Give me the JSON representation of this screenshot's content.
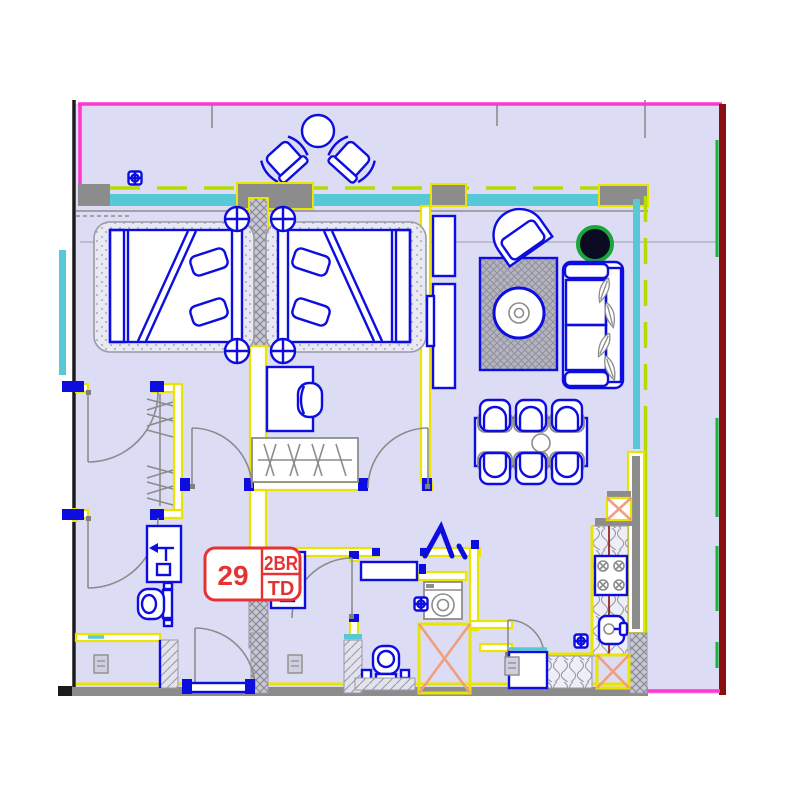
{
  "unit_label": {
    "number": "29",
    "type": "2BR",
    "suffix": "TD"
  },
  "palette": {
    "floor": "#dcdcf4",
    "blue": "#0d0de0",
    "yellow": "#e9e500",
    "gray": "#8c8c8c",
    "cyan": "#56c8d8",
    "chartreuse": "#b4dc00",
    "magenta": "#ff36d2",
    "darkred": "#8a0f0f",
    "green": "#17b33c",
    "orange": "#f19e7e",
    "red": "#e63232",
    "black": "#1b1b1b",
    "plant_fill": "#0b0b22",
    "plant_ring": "#19a63a"
  },
  "legend": {
    "unit_type_description": "2 bedroom unit, plan position 29",
    "icons": [
      "bed-icon",
      "nightstand-lamp-icon",
      "wardrobe-icon",
      "desk-icon",
      "sofa-icon",
      "armchair-icon",
      "coffee-table-icon",
      "plant-icon",
      "dining-table-icon",
      "dining-chair-icon",
      "stove-icon",
      "kitchen-sink-icon",
      "refrigerator-icon",
      "washing-machine-icon",
      "toilet-icon",
      "vanity-sink-icon",
      "shaft-cross-icon",
      "sprinkler-icon",
      "balcony-table-icon",
      "balcony-chair-icon"
    ]
  }
}
